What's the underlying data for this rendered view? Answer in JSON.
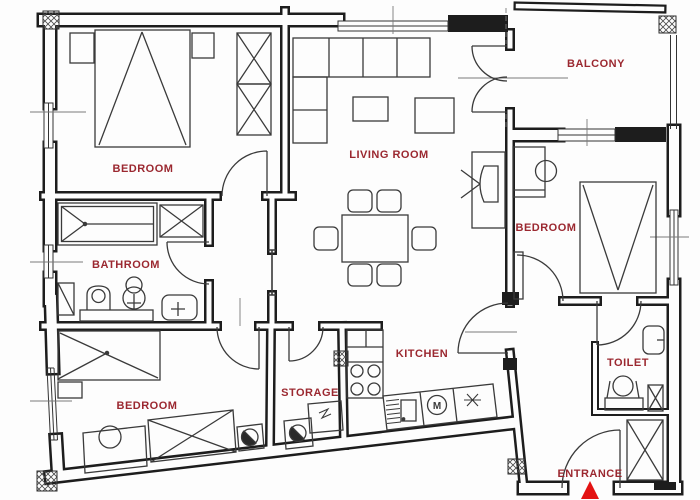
{
  "plan": {
    "rooms": {
      "bedroom_top_left": {
        "label": "BEDROOM"
      },
      "living_room": {
        "label": "LIVING ROOM"
      },
      "balcony": {
        "label": "BALCONY"
      },
      "bedroom_right": {
        "label": "BEDROOM"
      },
      "bathroom": {
        "label": "BATHROOM"
      },
      "bedroom_bottom_left": {
        "label": "BEDROOM"
      },
      "storage": {
        "label": "STORAGE"
      },
      "kitchen": {
        "label": "KITCHEN"
      },
      "toilet": {
        "label": "TOILET"
      },
      "entrance": {
        "label": "ENTRANCE"
      }
    },
    "symbols": {
      "washing_machine": "M"
    },
    "colors": {
      "label": "#9b2830",
      "wall": "#1d1d1d",
      "furniture": "#3a3a3a",
      "entrance_arrow": "#e31313"
    }
  }
}
